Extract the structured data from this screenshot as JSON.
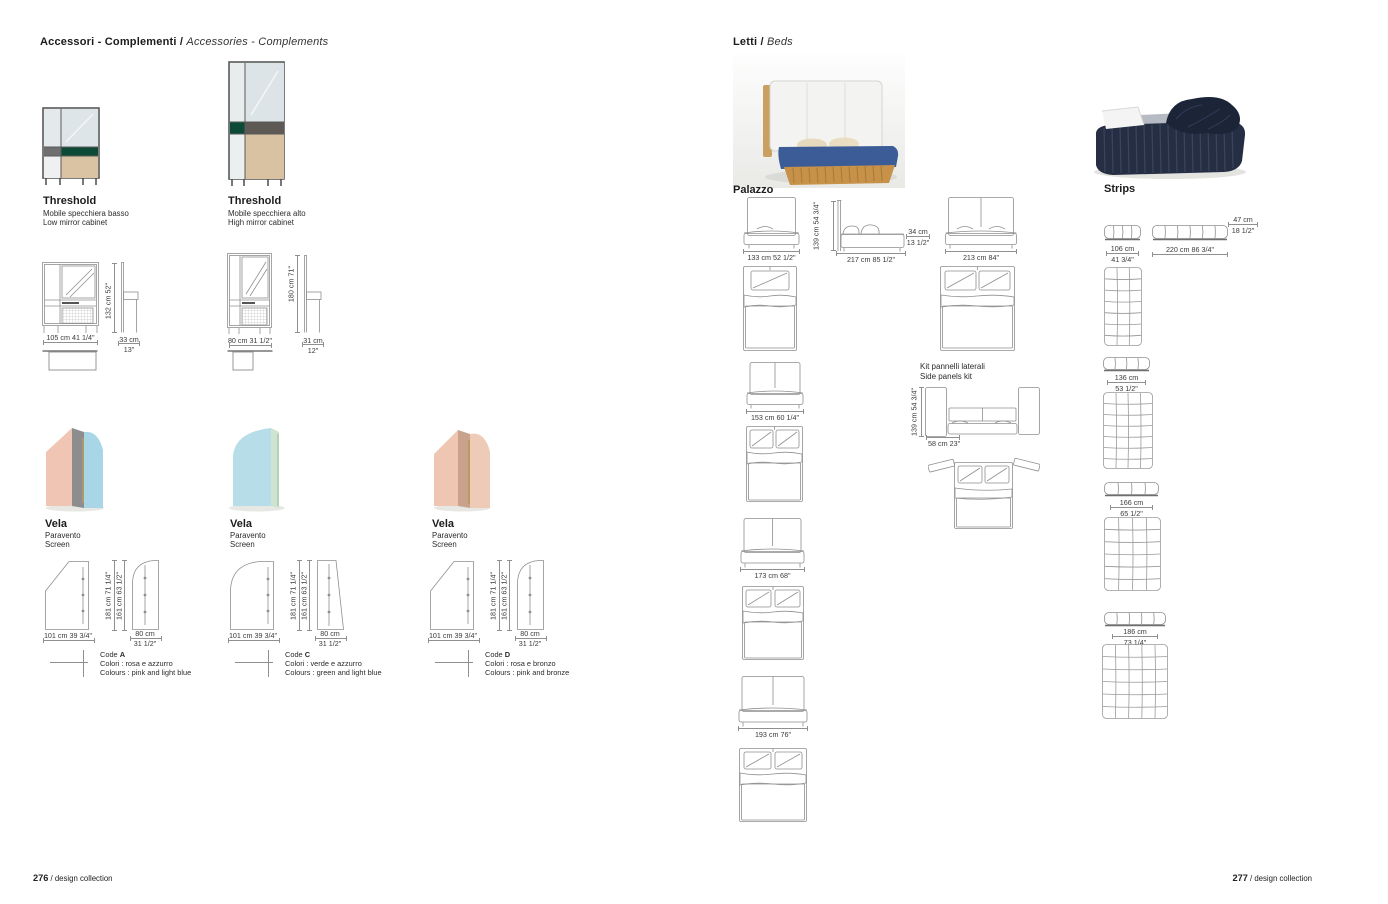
{
  "left_page": {
    "header": {
      "title_it": "Accessori - Complementi /",
      "title_en": "Accessories - Complements"
    },
    "threshold_low": {
      "name": "Threshold",
      "desc_it": "Mobile specchiera basso",
      "desc_en": "Low mirror cabinet",
      "dim_w": "105 cm 41 1/4\"",
      "dim_h": "132 cm 52\"",
      "dim_d_cm": "33 cm",
      "dim_d_in": "13\""
    },
    "threshold_high": {
      "name": "Threshold",
      "desc_it": "Mobile specchiera alto",
      "desc_en": "High mirror cabinet",
      "dim_w": "80 cm 31 1/2\"",
      "dim_h": "180 cm 71\"",
      "dim_d_cm": "31 cm",
      "dim_d_in": "12\""
    },
    "vela": [
      {
        "name": "Vela",
        "desc_it": "Paravento",
        "desc_en": "Screen",
        "dim_w": "101 cm 39 3/4\"",
        "dim_h1": "181 cm 71 1/4\"",
        "dim_h2": "161 cm 63 1/2\"",
        "dim_w2_cm": "80 cm",
        "dim_w2_in": "31 1/2\"",
        "code_label": "Code",
        "code": "A",
        "colori": "Colori : rosa e azzurro",
        "colours": "Colours : pink and light blue"
      },
      {
        "name": "Vela",
        "desc_it": "Paravento",
        "desc_en": "Screen",
        "dim_w": "101 cm 39 3/4\"",
        "dim_h1": "181 cm 71 1/4\"",
        "dim_h2": "161 cm 63 1/2\"",
        "dim_w2_cm": "80 cm",
        "dim_w2_in": "31 1/2\"",
        "code_label": "Code",
        "code": "C",
        "colori": "Colori : verde e azzurro",
        "colours": "Colours : green and light blue"
      },
      {
        "name": "Vela",
        "desc_it": "Paravento",
        "desc_en": "Screen",
        "dim_w": "101 cm 39 3/4\"",
        "dim_h1": "181 cm 71 1/4\"",
        "dim_h2": "161 cm 63 1/2\"",
        "dim_w2_cm": "80 cm",
        "dim_w2_in": "31 1/2\"",
        "code_label": "Code",
        "code": "D",
        "colori": "Colori : rosa e bronzo",
        "colours": "Colours : pink and bronze"
      }
    ],
    "footer": {
      "page": "276",
      "label": "/ design collection"
    }
  },
  "right_page": {
    "header": {
      "title_it": "Letti /",
      "title_en": "Beds"
    },
    "palazzo": {
      "name": "Palazzo",
      "w133": "133 cm 52 1/2\"",
      "h139": "139 cm 54 3/4\"",
      "l217": "217 cm 85 1/2\"",
      "h34_cm": "34 cm",
      "h34_in": "13 1/2\"",
      "w213": "213 cm 84\"",
      "w153": "153 cm 60 1/4\"",
      "w173": "173 cm 68\"",
      "w193": "193 cm 76\"",
      "kit_title_it": "Kit pannelli laterali",
      "kit_title_en": "Side panels kit",
      "kit_h": "139 cm 54 3/4\"",
      "kit_w": "58 cm 23\""
    },
    "strips": {
      "name": "Strips",
      "h47_cm": "47 cm",
      "h47_in": "18 1/2\"",
      "w106_cm": "106 cm",
      "w106_in": "41 3/4\"",
      "l220": "220 cm 86 3/4\"",
      "w136_cm": "136 cm",
      "w136_in": "53 1/2\"",
      "w166_cm": "166 cm",
      "w166_in": "65 1/2\"",
      "w186_cm": "186 cm",
      "w186_in": "73 1/4\""
    },
    "footer": {
      "page": "277",
      "label": "/ design collection"
    }
  }
}
